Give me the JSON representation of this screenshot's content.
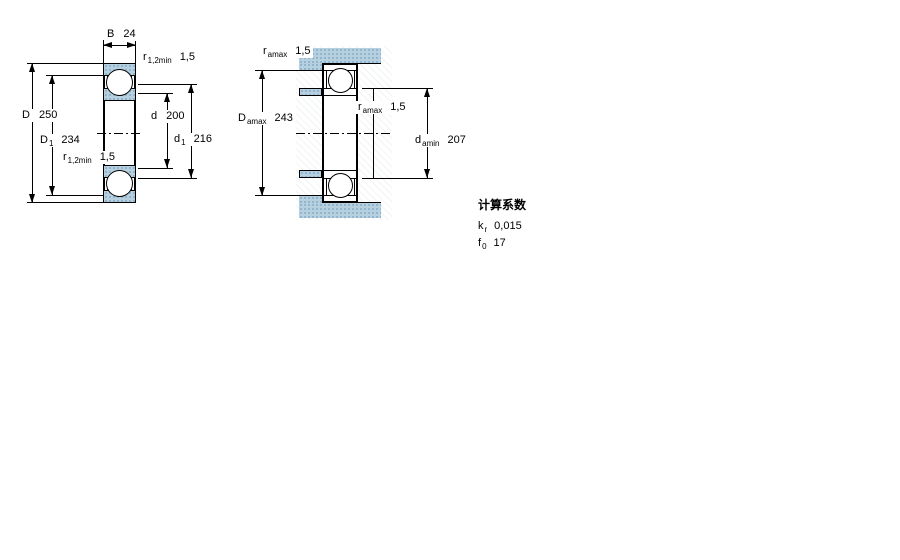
{
  "colors": {
    "hatch_fill": "#b7d0e0",
    "hatch_dot": "#86acc8",
    "line_color": "#000000",
    "background": "#ffffff"
  },
  "left_drawing": {
    "B": {
      "sym": "B",
      "sub": "",
      "val": "24"
    },
    "r_top": {
      "sym": "r",
      "sub": "1,2min",
      "val": "1,5"
    },
    "D": {
      "sym": "D",
      "sub": "",
      "val": "250"
    },
    "D1": {
      "sym": "D",
      "sub": "1",
      "val": "234"
    },
    "r_mid": {
      "sym": "r",
      "sub": "1,2min",
      "val": "1,5"
    },
    "d": {
      "sym": "d",
      "sub": "",
      "val": "200"
    },
    "d1": {
      "sym": "d",
      "sub": "1",
      "val": "216"
    }
  },
  "right_drawing": {
    "r_a_top": {
      "sym": "r",
      "sub": "amax",
      "val": "1,5"
    },
    "D_a": {
      "sym": "D",
      "sub": "amax",
      "val": "243"
    },
    "r_a_mid": {
      "sym": "r",
      "sub": "amax",
      "val": "1,5"
    },
    "d_a": {
      "sym": "d",
      "sub": "amin",
      "val": "207"
    }
  },
  "calculation_factors": {
    "title": "计算系数",
    "rows": [
      {
        "sym": "k",
        "sub": "r",
        "val": "0,015"
      },
      {
        "sym": "f",
        "sub": "0",
        "val": "17"
      }
    ]
  }
}
